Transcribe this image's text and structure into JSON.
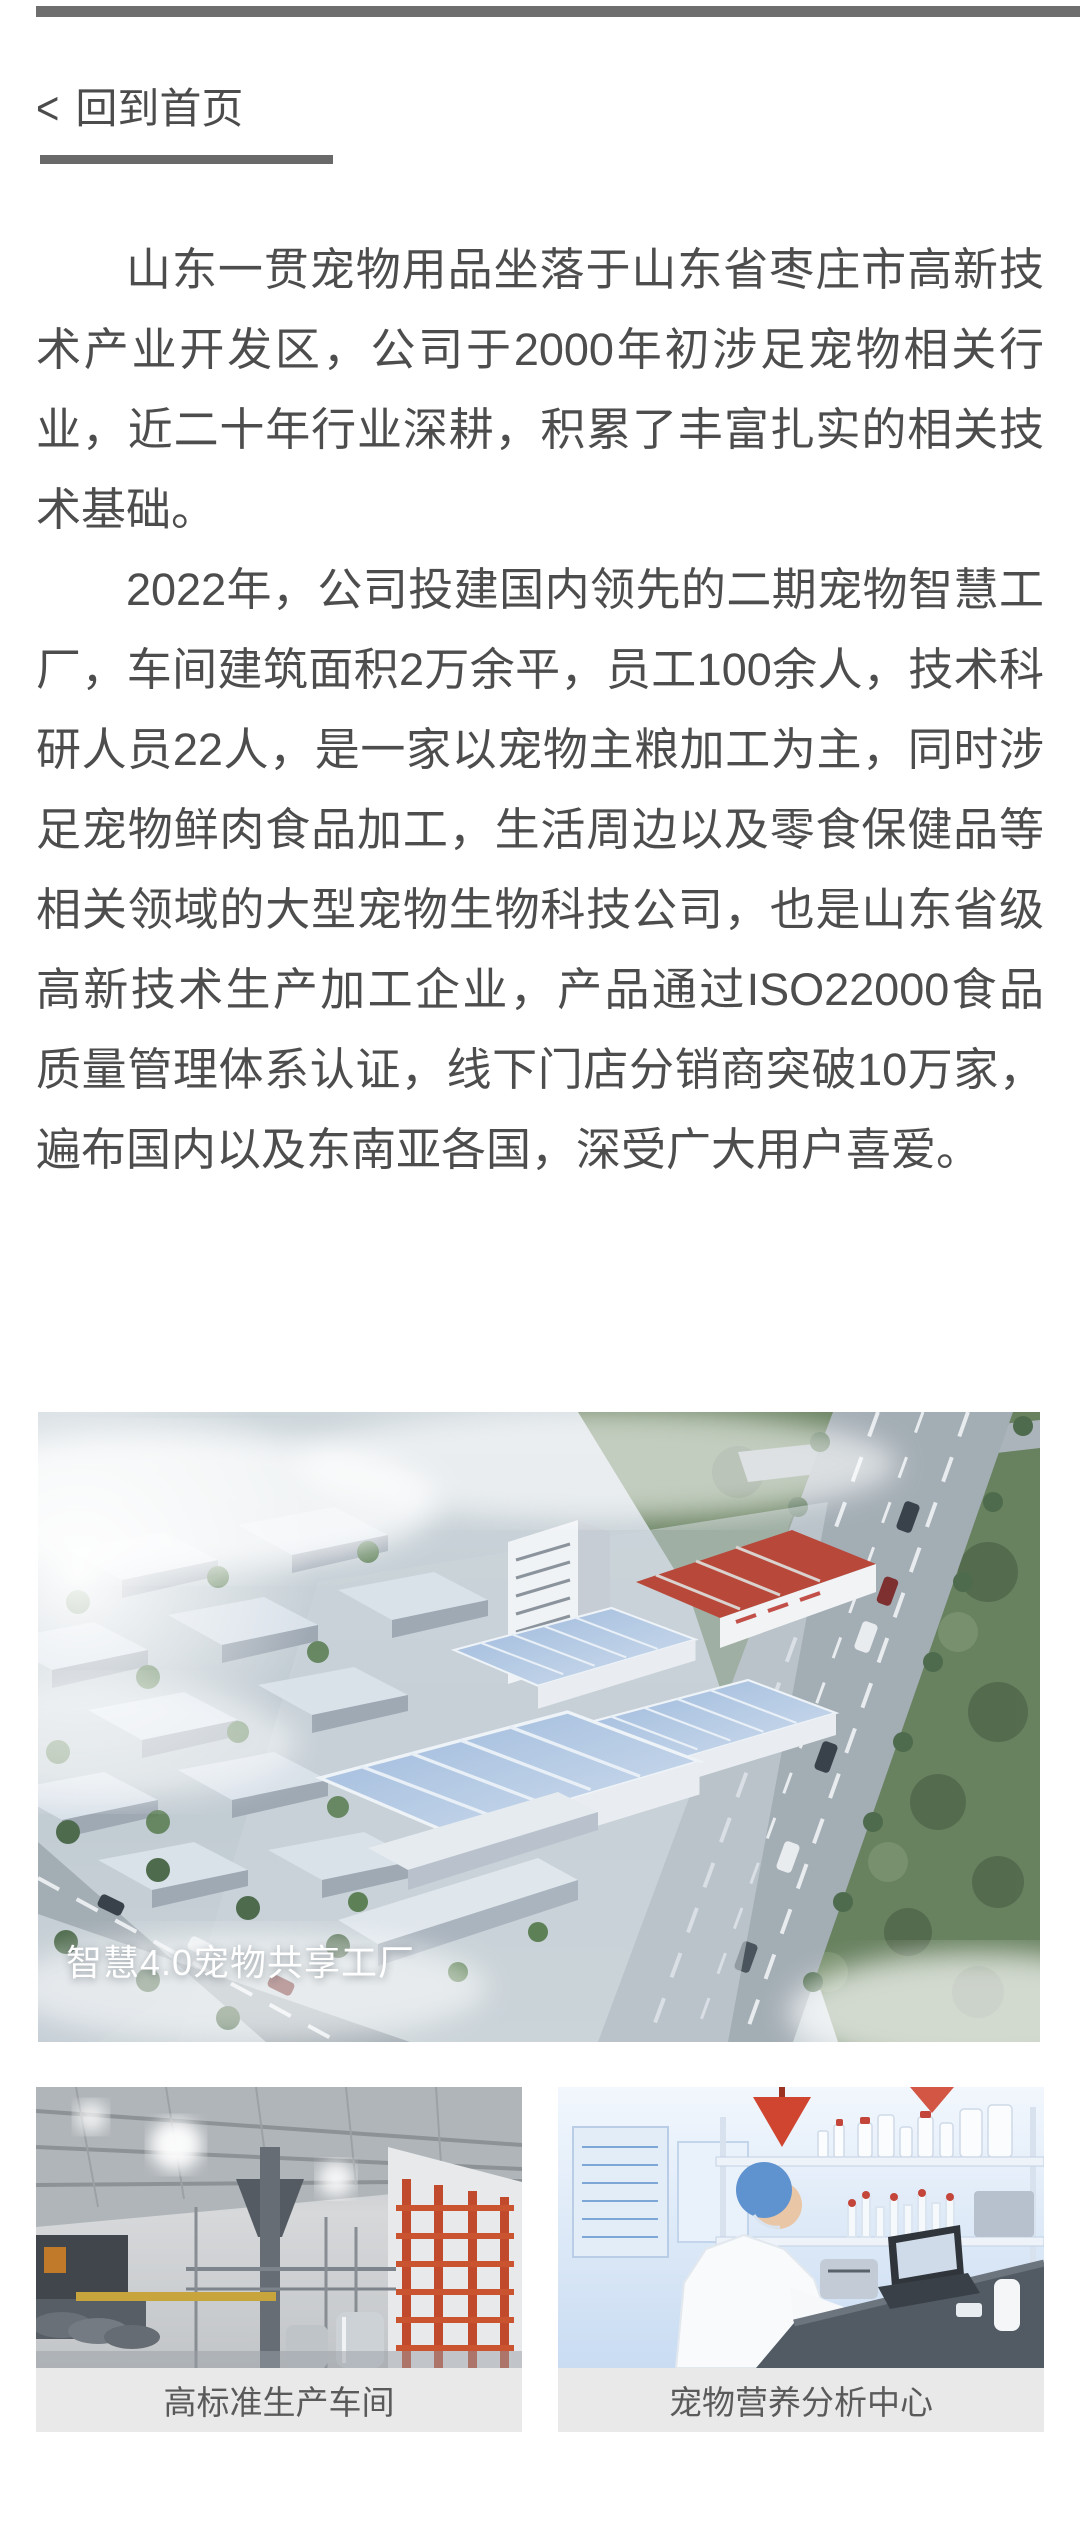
{
  "back_link": {
    "chevron": "<",
    "label": "回到首页"
  },
  "article": {
    "paragraphs": [
      "山东一贯宠物用品坐落于山东省枣庄市高新技术产业开发区，公司于2000年初涉足宠物相关行业，近二十年行业深耕，积累了丰富扎实的相关技术基础。",
      "2022年，公司投建国内领先的二期宠物智慧工厂，车间建筑面积2万余平，员工100余人，技术科研人员22人，是一家以宠物主粮加工为主，同时涉足宠物鲜肉食品加工，生活周边以及零食保健品等相关领域的大型宠物生物科技公司，也是山东省级高新技术生产加工企业，产品通过ISO22000食品质量管理体系认证，线下门店分销商突破10万家，遍布国内以及东南亚各国，深受广大用户喜爱。"
    ]
  },
  "hero": {
    "caption": "智慧4.0宠物共享工厂"
  },
  "gallery": {
    "items": [
      {
        "caption": "高标准生产车间"
      },
      {
        "caption": "宠物营养分析中心"
      }
    ]
  },
  "colors": {
    "top_bar": "#6e6e6e",
    "divider": "#696969",
    "body_text": "#4d4d4d",
    "hero_caption_text": "#ffffff",
    "card_caption_bg": "#e9e9e9",
    "card_caption_text": "#5a5a5a",
    "factory_red_roof": "#b8483a",
    "glass_roof_blue": "#a6bedd",
    "rack_red": "#c14a2c",
    "lab_blue": "#5f93cf"
  }
}
